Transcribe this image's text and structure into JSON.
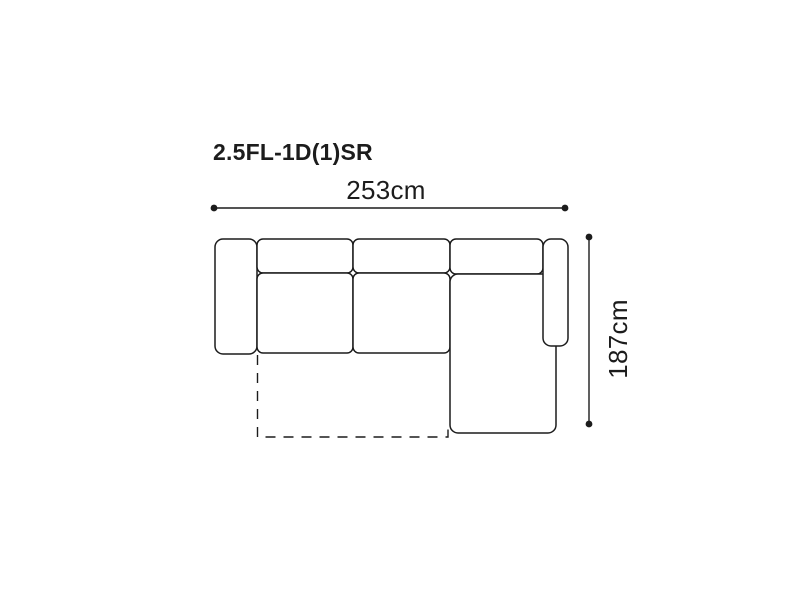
{
  "diagram": {
    "title": "2.5FL-1D(1)SR",
    "horizontal_dimension": {
      "label": "253cm",
      "value_cm": 253
    },
    "vertical_dimension": {
      "label": "187cm",
      "value_cm": 187
    },
    "colors": {
      "line": "#1c1c1c",
      "text": "#1c1c1c",
      "background": "#ffffff"
    }
  }
}
